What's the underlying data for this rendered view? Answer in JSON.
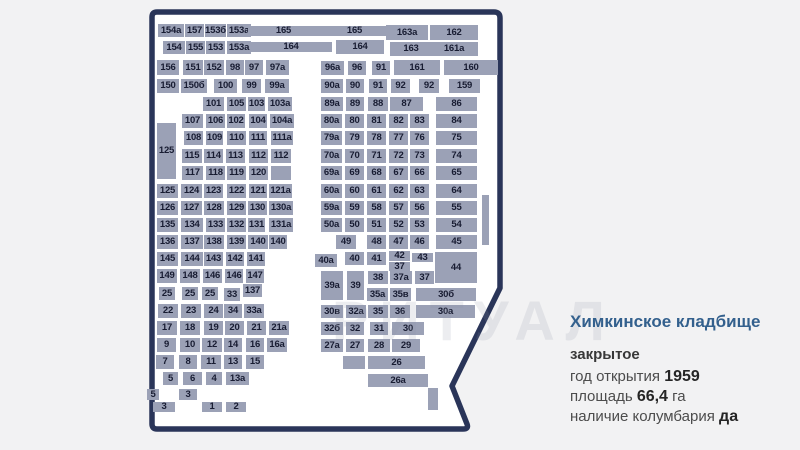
{
  "watermark": "РИТУАЛ",
  "info": {
    "title": "Химкинское кладбище",
    "status": "закрытое",
    "rows": [
      {
        "label": "год открытия",
        "value": "1959",
        "suffix": ""
      },
      {
        "label": "площадь",
        "value": "66,4",
        "suffix": "га"
      },
      {
        "label": "наличие колумбария",
        "value": "да",
        "suffix": ""
      }
    ]
  },
  "colors": {
    "boundary": "#2a3559",
    "block_fill": "#9ba1b6",
    "block_text": "#181c32",
    "title_blue": "#33608d",
    "map_inner": "#ffffff",
    "page_bg": "#f2f2f3"
  },
  "map": {
    "blocks": [
      [
        "154a",
        158,
        24,
        26,
        13
      ],
      [
        "157",
        185,
        24,
        19,
        13
      ],
      [
        "153б",
        205,
        24,
        21,
        13
      ],
      [
        "153a",
        227,
        24,
        24,
        13
      ],
      [
        "165",
        248,
        26,
        71,
        10
      ],
      [
        "165",
        319,
        26,
        71,
        10
      ],
      [
        "163a",
        386,
        25,
        42,
        15
      ],
      [
        "162",
        430,
        25,
        48,
        15
      ],
      [
        "154",
        163,
        41,
        22,
        13
      ],
      [
        "155",
        186,
        41,
        19,
        13
      ],
      [
        "153",
        206,
        41,
        19,
        13
      ],
      [
        "153a",
        227,
        41,
        24,
        13
      ],
      [
        "164",
        250,
        42,
        82,
        10
      ],
      [
        "164",
        336,
        40,
        48,
        14
      ],
      [
        "163",
        390,
        42,
        42,
        14
      ],
      [
        "161a",
        430,
        42,
        48,
        14
      ],
      [
        "156",
        157,
        60,
        22,
        15
      ],
      [
        "151",
        183,
        60,
        20,
        15
      ],
      [
        "152",
        204,
        60,
        20,
        15
      ],
      [
        "98",
        226,
        60,
        18,
        15
      ],
      [
        "97",
        245,
        60,
        18,
        15
      ],
      [
        "97a",
        266,
        60,
        23,
        15
      ],
      [
        "96a",
        321,
        61,
        23,
        14
      ],
      [
        "96",
        348,
        61,
        18,
        14
      ],
      [
        "91",
        372,
        61,
        18,
        14
      ],
      [
        "161",
        394,
        60,
        46,
        15
      ],
      [
        "160",
        444,
        60,
        54,
        15
      ],
      [
        "150",
        157,
        79,
        22,
        14
      ],
      [
        "150б",
        181,
        79,
        26,
        14
      ],
      [
        "100",
        214,
        79,
        23,
        14
      ],
      [
        "99",
        242,
        79,
        19,
        14
      ],
      [
        "99a",
        265,
        79,
        24,
        14
      ],
      [
        "90a",
        321,
        79,
        22,
        14
      ],
      [
        "90",
        346,
        79,
        18,
        14
      ],
      [
        "91",
        369,
        79,
        18,
        14
      ],
      [
        "92",
        391,
        79,
        19,
        14
      ],
      [
        "92",
        419,
        79,
        20,
        14
      ],
      [
        "159",
        449,
        79,
        31,
        14
      ],
      [
        "101",
        203,
        97,
        21,
        14
      ],
      [
        "105",
        227,
        97,
        19,
        14
      ],
      [
        "103",
        248,
        97,
        17,
        14
      ],
      [
        "103a",
        268,
        97,
        24,
        14
      ],
      [
        "89a",
        321,
        97,
        22,
        14
      ],
      [
        "89",
        346,
        97,
        18,
        14
      ],
      [
        "88",
        368,
        97,
        20,
        14
      ],
      [
        "87",
        390,
        97,
        33,
        14
      ],
      [
        "86",
        436,
        97,
        41,
        14
      ],
      [
        "107",
        182,
        114,
        21,
        14
      ],
      [
        "106",
        206,
        114,
        19,
        14
      ],
      [
        "102",
        227,
        114,
        18,
        14
      ],
      [
        "104",
        249,
        114,
        18,
        14
      ],
      [
        "104a",
        270,
        114,
        24,
        14
      ],
      [
        "80a",
        321,
        114,
        21,
        14
      ],
      [
        "80",
        345,
        114,
        19,
        14
      ],
      [
        "81",
        367,
        114,
        19,
        14
      ],
      [
        "82",
        389,
        114,
        19,
        14
      ],
      [
        "83",
        410,
        114,
        19,
        14
      ],
      [
        "84",
        436,
        114,
        41,
        14
      ],
      [
        "125",
        157,
        123,
        19,
        56
      ],
      [
        "108",
        184,
        131,
        19,
        14
      ],
      [
        "109",
        206,
        131,
        17,
        14
      ],
      [
        "110",
        227,
        131,
        19,
        14
      ],
      [
        "111",
        249,
        131,
        18,
        14
      ],
      [
        "111a",
        271,
        131,
        22,
        14
      ],
      [
        "79a",
        321,
        131,
        21,
        14
      ],
      [
        "79",
        345,
        131,
        19,
        14
      ],
      [
        "78",
        367,
        131,
        19,
        14
      ],
      [
        "77",
        389,
        131,
        19,
        14
      ],
      [
        "76",
        410,
        131,
        19,
        14
      ],
      [
        "75",
        436,
        131,
        41,
        14
      ],
      [
        "115",
        182,
        149,
        20,
        14
      ],
      [
        "114",
        204,
        149,
        19,
        14
      ],
      [
        "113",
        226,
        149,
        19,
        14
      ],
      [
        "112",
        249,
        149,
        19,
        14
      ],
      [
        "112",
        271,
        149,
        20,
        14
      ],
      [
        "70a",
        321,
        149,
        21,
        14
      ],
      [
        "70",
        345,
        149,
        19,
        14
      ],
      [
        "71",
        367,
        149,
        19,
        14
      ],
      [
        "72",
        389,
        149,
        19,
        14
      ],
      [
        "73",
        410,
        149,
        19,
        14
      ],
      [
        "74",
        436,
        149,
        41,
        14
      ],
      [
        "117",
        182,
        166,
        21,
        14
      ],
      [
        "118",
        206,
        166,
        19,
        14
      ],
      [
        "119",
        227,
        166,
        19,
        14
      ],
      [
        "120",
        249,
        166,
        19,
        14
      ],
      [
        "",
        271,
        166,
        20,
        14
      ],
      [
        "69a",
        321,
        166,
        21,
        14
      ],
      [
        "69",
        345,
        166,
        19,
        14
      ],
      [
        "68",
        367,
        166,
        19,
        14
      ],
      [
        "67",
        389,
        166,
        19,
        14
      ],
      [
        "66",
        410,
        166,
        19,
        14
      ],
      [
        "65",
        436,
        166,
        41,
        14
      ],
      [
        "125",
        157,
        184,
        21,
        14
      ],
      [
        "124",
        181,
        184,
        21,
        14
      ],
      [
        "123",
        204,
        184,
        19,
        14
      ],
      [
        "122",
        227,
        184,
        19,
        14
      ],
      [
        "121",
        249,
        184,
        18,
        14
      ],
      [
        "121a",
        269,
        184,
        23,
        14
      ],
      [
        "60a",
        321,
        184,
        21,
        14
      ],
      [
        "60",
        345,
        184,
        19,
        14
      ],
      [
        "61",
        367,
        184,
        19,
        14
      ],
      [
        "62",
        389,
        184,
        19,
        14
      ],
      [
        "63",
        410,
        184,
        19,
        14
      ],
      [
        "64",
        436,
        184,
        41,
        14
      ],
      [
        "126",
        157,
        201,
        21,
        14
      ],
      [
        "127",
        181,
        201,
        21,
        14
      ],
      [
        "128",
        204,
        201,
        20,
        14
      ],
      [
        "129",
        227,
        201,
        19,
        14
      ],
      [
        "130",
        248,
        201,
        19,
        14
      ],
      [
        "130a",
        269,
        201,
        24,
        14
      ],
      [
        "59a",
        321,
        201,
        21,
        14
      ],
      [
        "59",
        345,
        201,
        19,
        14
      ],
      [
        "58",
        367,
        201,
        19,
        14
      ],
      [
        "57",
        389,
        201,
        19,
        14
      ],
      [
        "56",
        410,
        201,
        19,
        14
      ],
      [
        "55",
        436,
        201,
        41,
        14
      ],
      [
        "135",
        157,
        218,
        21,
        14
      ],
      [
        "134",
        181,
        218,
        22,
        14
      ],
      [
        "133",
        206,
        218,
        19,
        14
      ],
      [
        "132",
        227,
        218,
        19,
        14
      ],
      [
        "131",
        248,
        218,
        17,
        14
      ],
      [
        "131a",
        269,
        218,
        24,
        14
      ],
      [
        "50a",
        321,
        218,
        21,
        14
      ],
      [
        "50",
        345,
        218,
        19,
        14
      ],
      [
        "51",
        367,
        218,
        19,
        14
      ],
      [
        "52",
        389,
        218,
        19,
        14
      ],
      [
        "53",
        410,
        218,
        19,
        14
      ],
      [
        "54",
        436,
        218,
        41,
        14
      ],
      [
        "136",
        157,
        235,
        21,
        14
      ],
      [
        "137",
        181,
        235,
        22,
        14
      ],
      [
        "138",
        204,
        235,
        20,
        14
      ],
      [
        "139",
        227,
        235,
        19,
        14
      ],
      [
        "140",
        248,
        235,
        20,
        14
      ],
      [
        "140",
        269,
        235,
        18,
        14
      ],
      [
        "49",
        336,
        235,
        20,
        14
      ],
      [
        "48",
        367,
        235,
        19,
        14
      ],
      [
        "47",
        389,
        235,
        19,
        14
      ],
      [
        "46",
        410,
        235,
        19,
        14
      ],
      [
        "45",
        436,
        235,
        41,
        14
      ],
      [
        "",
        482,
        195,
        7,
        50
      ],
      [
        "145",
        157,
        252,
        21,
        14
      ],
      [
        "144",
        181,
        252,
        22,
        14
      ],
      [
        "143",
        204,
        252,
        19,
        14
      ],
      [
        "142",
        226,
        252,
        18,
        14
      ],
      [
        "141",
        247,
        252,
        18,
        14
      ],
      [
        "40a",
        315,
        254,
        22,
        13
      ],
      [
        "40",
        345,
        252,
        19,
        13
      ],
      [
        "41",
        367,
        252,
        19,
        13
      ],
      [
        "42",
        389,
        251,
        21,
        10
      ],
      [
        "37",
        389,
        262,
        21,
        9
      ],
      [
        "43",
        412,
        253,
        21,
        9
      ],
      [
        "44",
        435,
        252,
        42,
        31
      ],
      [
        "149",
        157,
        269,
        20,
        14
      ],
      [
        "148",
        180,
        269,
        20,
        14
      ],
      [
        "146",
        203,
        269,
        19,
        14
      ],
      [
        "146",
        225,
        269,
        18,
        14
      ],
      [
        "147",
        246,
        269,
        18,
        14
      ],
      [
        "39a",
        321,
        271,
        22,
        29
      ],
      [
        "39",
        347,
        271,
        17,
        29
      ],
      [
        "38",
        368,
        271,
        20,
        13
      ],
      [
        "37a",
        390,
        271,
        22,
        13
      ],
      [
        "37",
        415,
        271,
        19,
        13
      ],
      [
        "25",
        159,
        287,
        16,
        13
      ],
      [
        "25",
        182,
        287,
        16,
        13
      ],
      [
        "25",
        202,
        287,
        16,
        13
      ],
      [
        "33",
        224,
        288,
        16,
        13
      ],
      [
        "137",
        243,
        284,
        19,
        13
      ],
      [
        "35a",
        367,
        288,
        21,
        13
      ],
      [
        "35в",
        390,
        288,
        21,
        13
      ],
      [
        "30б",
        416,
        288,
        60,
        13
      ],
      [
        "22",
        158,
        304,
        20,
        14
      ],
      [
        "23",
        181,
        304,
        20,
        14
      ],
      [
        "24",
        204,
        304,
        19,
        14
      ],
      [
        "34",
        224,
        304,
        18,
        14
      ],
      [
        "33a",
        244,
        304,
        20,
        14
      ],
      [
        "30в",
        321,
        305,
        22,
        13
      ],
      [
        "32a",
        346,
        305,
        20,
        13
      ],
      [
        "35",
        368,
        305,
        20,
        13
      ],
      [
        "36",
        390,
        305,
        20,
        13
      ],
      [
        "30a",
        416,
        305,
        59,
        13
      ],
      [
        "17",
        157,
        321,
        20,
        14
      ],
      [
        "18",
        180,
        321,
        20,
        14
      ],
      [
        "19",
        204,
        321,
        19,
        14
      ],
      [
        "20",
        225,
        321,
        19,
        14
      ],
      [
        "21",
        247,
        321,
        19,
        14
      ],
      [
        "21a",
        269,
        321,
        20,
        14
      ],
      [
        "32б",
        321,
        322,
        22,
        13
      ],
      [
        "32",
        346,
        322,
        18,
        13
      ],
      [
        "31",
        370,
        322,
        18,
        13
      ],
      [
        "30",
        392,
        322,
        32,
        13
      ],
      [
        "9",
        157,
        338,
        19,
        14
      ],
      [
        "10",
        180,
        338,
        20,
        14
      ],
      [
        "12",
        202,
        338,
        20,
        14
      ],
      [
        "14",
        224,
        338,
        18,
        14
      ],
      [
        "16",
        246,
        338,
        18,
        14
      ],
      [
        "16a",
        267,
        338,
        20,
        14
      ],
      [
        "27a",
        321,
        339,
        22,
        13
      ],
      [
        "27",
        346,
        339,
        18,
        13
      ],
      [
        "28",
        368,
        339,
        22,
        13
      ],
      [
        "29",
        392,
        339,
        28,
        13
      ],
      [
        "7",
        156,
        355,
        18,
        14
      ],
      [
        "8",
        179,
        355,
        18,
        14
      ],
      [
        "11",
        201,
        355,
        20,
        14
      ],
      [
        "13",
        224,
        355,
        18,
        14
      ],
      [
        "15",
        246,
        355,
        18,
        14
      ],
      [
        "",
        343,
        356,
        22,
        13
      ],
      [
        "26",
        368,
        356,
        57,
        13
      ],
      [
        "5",
        163,
        372,
        15,
        13
      ],
      [
        "6",
        183,
        372,
        19,
        13
      ],
      [
        "4",
        206,
        372,
        16,
        13
      ],
      [
        "13a",
        226,
        372,
        23,
        13
      ],
      [
        "26a",
        368,
        374,
        60,
        13
      ],
      [
        "",
        428,
        388,
        10,
        22
      ],
      [
        "5",
        147,
        389,
        12,
        11
      ],
      [
        "3",
        179,
        389,
        18,
        11
      ],
      [
        "3",
        153,
        402,
        22,
        10
      ],
      [
        "1",
        202,
        402,
        20,
        10
      ],
      [
        "2",
        226,
        402,
        20,
        10
      ]
    ]
  }
}
